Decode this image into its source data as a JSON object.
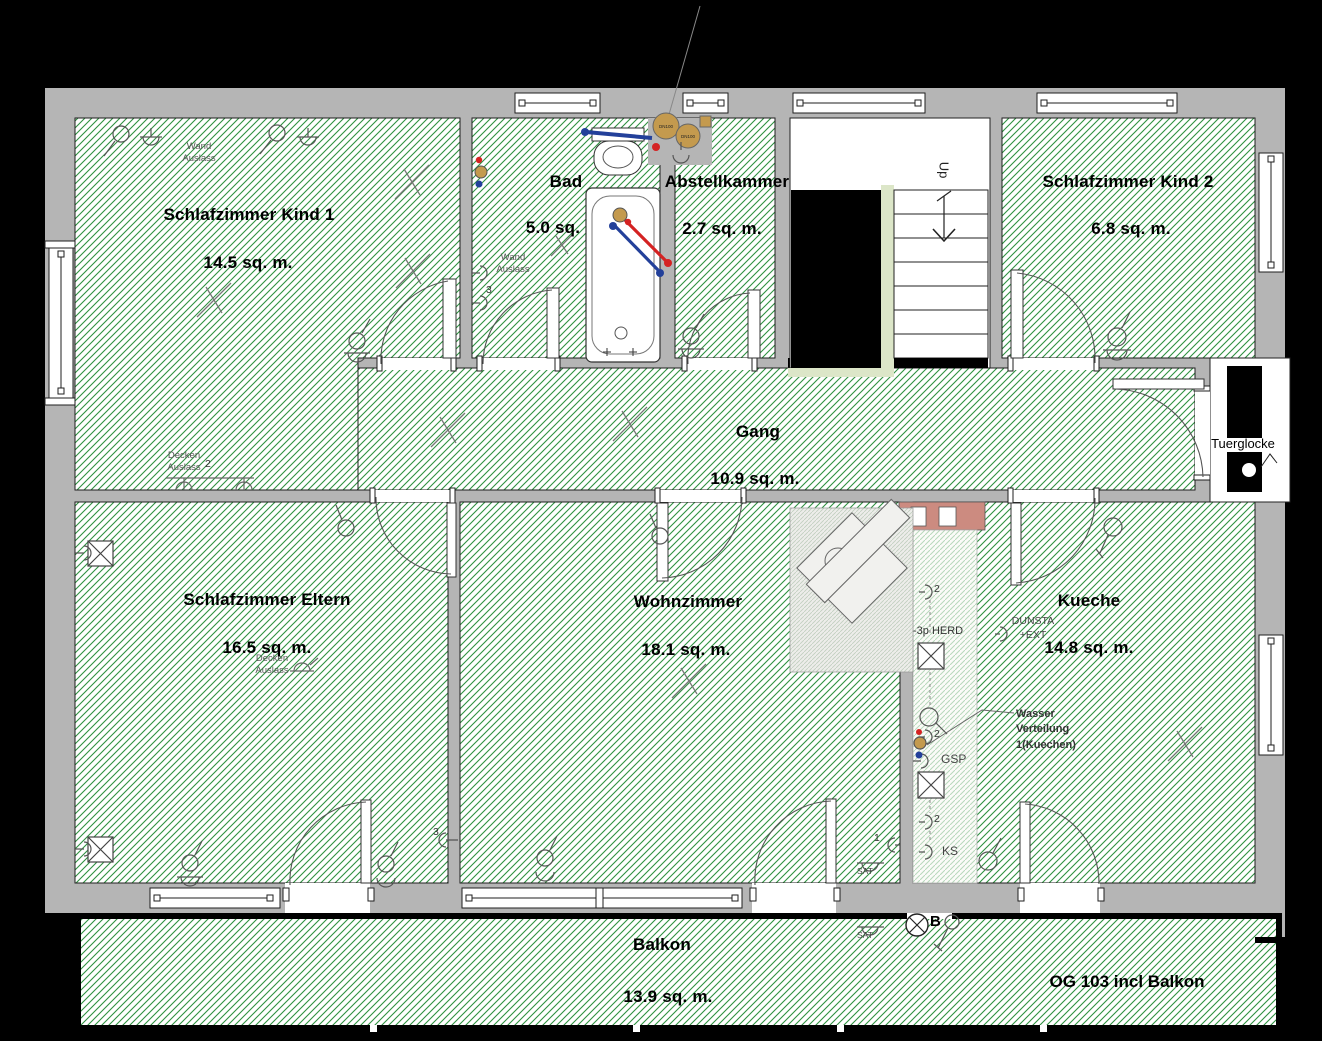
{
  "plan": {
    "title_label": "OG 103 incl Balkon",
    "doorbell_label": "Tuerglocke",
    "stairs_direction_label": "Up"
  },
  "rooms": {
    "schlafzimmer_kind_1": {
      "name": "Schlafzimmer Kind 1",
      "area": "14.5 sq. m."
    },
    "bad": {
      "name": "Bad",
      "area": "5.0 sq."
    },
    "abstellkammer": {
      "name": "Abstellkammer",
      "area": "2.7 sq. m."
    },
    "schlafzimmer_kind_2": {
      "name": "Schlafzimmer Kind 2",
      "area": "6.8 sq. m."
    },
    "gang": {
      "name": "Gang",
      "area": "10.9 sq. m."
    },
    "schlafzimmer_eltern": {
      "name": "Schlafzimmer Eltern",
      "area": "16.5 sq. m."
    },
    "wohnzimmer": {
      "name": "Wohnzimmer",
      "area": "18.1 sq. m."
    },
    "kueche": {
      "name": "Kueche",
      "area": "14.8 sq. m."
    },
    "balkon": {
      "name": "Balkon",
      "area": "13.9 sq. m."
    }
  },
  "electrical": {
    "wand_auslass_kind1_label": "Wand Auslass",
    "wand_auslass_bad_label": "Wand Auslass",
    "wand_auslass_bad_count": "3",
    "decken_auslass_kind1_label": "Decken Auslass",
    "decken_auslass_kind1_count": "2",
    "decken_auslass_eltern_label": "Decken Auslass",
    "eltern_switch_count": "3",
    "wohnzimmer_switch_count": "1",
    "wohnzimmer_sat_label": "SAT",
    "balkon_sat_label": "SAT",
    "balkon_b_label": "B"
  },
  "kitchen": {
    "herd_label": "-3p HERD",
    "dunst_label": "DUNSTA +EXT",
    "gsp_label": "GSP",
    "ks_label": "KS",
    "socket_count_top": "2",
    "socket_count_mid": "2",
    "socket_count_bottom": "2",
    "wasser_label": "Wasser Verteilung 1(Kuechen)"
  },
  "plumbing": {
    "dn_label_1": "DN100",
    "dn_label_2": "DN100"
  },
  "colors": {
    "background": "#000000",
    "wall": "#b5b5b5",
    "hatch_green": "#2e9140",
    "stair_accent": "#dce6c8",
    "counter": "#cc8b80",
    "pipe_hot": "#d42222",
    "pipe_cold": "#23409a",
    "fitting_brass": "#c49a4e"
  }
}
